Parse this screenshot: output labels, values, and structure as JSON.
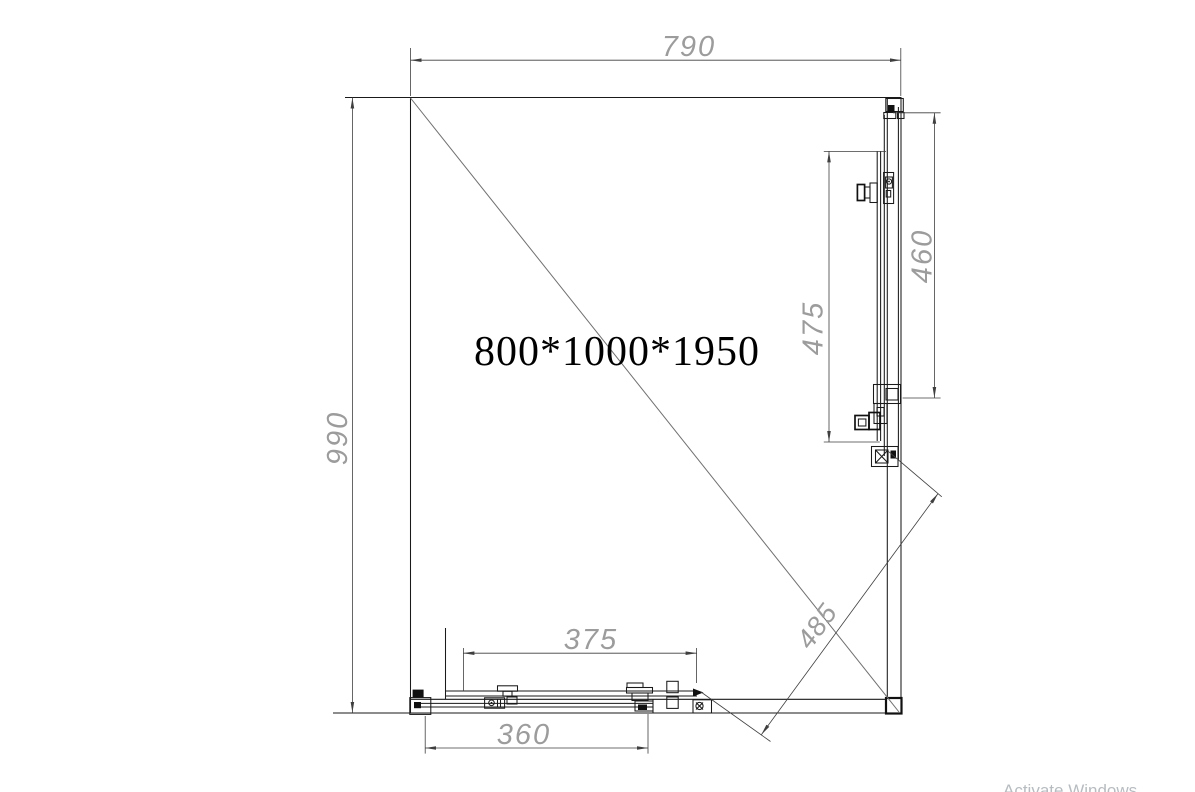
{
  "drawing": {
    "product_title": "800*1000*1950",
    "dims": {
      "top": "790",
      "left": "990",
      "right_inner": "475",
      "right_outer": "460",
      "bottom_inner": "375",
      "bottom_outer": "360",
      "diagonal": "485"
    }
  },
  "watermark": {
    "line1": "Activate Windows"
  },
  "colors": {
    "background": "#ffffff",
    "line": "#1a1a1a",
    "dimension_line": "#3f3f3f",
    "dimension_text": "#9c9c9c",
    "title_text": "#000000"
  }
}
